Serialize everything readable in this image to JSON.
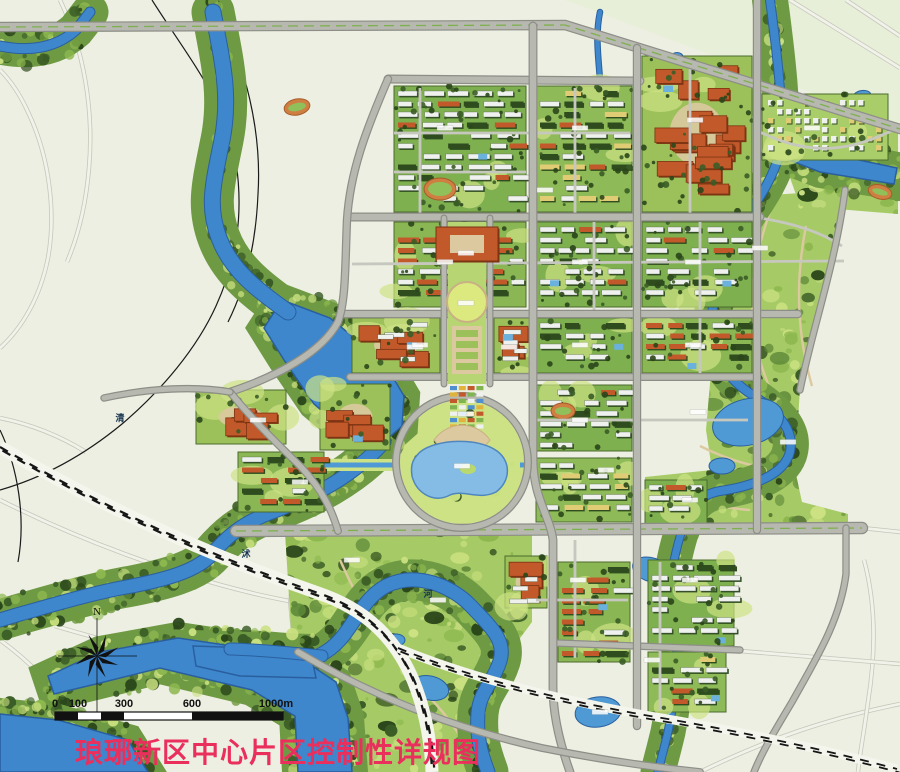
{
  "title": {
    "text": "琅琊新区中心片区控制性详规图"
  },
  "compass": {
    "label": "N"
  },
  "scale_bar": {
    "labels": [
      "0",
      "100",
      "300",
      "600",
      "1000m"
    ],
    "ticks_px": [
      55,
      78,
      124,
      192,
      283
    ]
  },
  "river_labels": [
    {
      "t": "清",
      "x": 120,
      "y": 421
    },
    {
      "t": "沭",
      "x": 246,
      "y": 557
    },
    {
      "t": "河",
      "x": 428,
      "y": 597
    }
  ],
  "palette": {
    "bg": "#edefe2",
    "tintNE": "#e8efd9",
    "roadFill": "#b7b8b0",
    "roadEdge": "#8d8e87",
    "minor": "#c6c7be",
    "outsideA": "#c6c7ba",
    "outsideB": "#f1f2e9",
    "river": "#3e87cc",
    "riverEdge": "#2a5f9f",
    "lake": "#85bce6",
    "pond": "#4f9ad4",
    "bank": "#6f9a44",
    "parkBase": "#a6cb66",
    "parkLight": "#cde284",
    "parkYellow": "#dce97f",
    "forest": "#3a5c26",
    "forestDark": "#2a461a",
    "grass": "#8db84f",
    "base_resw": "#7fb04f",
    "base_resr": "#8ab653",
    "base_resm": "#8fba58",
    "base_villa": "#a9cd68",
    "base_civic": "#9cc05a",
    "white": "#eff1ee",
    "red": "#c2592a",
    "redDark": "#7c3413",
    "yellow": "#e0cc74",
    "shadow": "#2f4d1f",
    "tan": "#dcc9a0",
    "tanEdge": "#c8b184",
    "rail": "#161616",
    "title": "#ea2f5d",
    "ink": "#111111",
    "water_label": "#14324f",
    "market": [
      "#4f8fd0",
      "#e2b33c",
      "#c2592a",
      "#7fb450",
      "#eff1ee"
    ],
    "track_ring": "#cf7f42",
    "track_field": "#8fc05a"
  },
  "geometry": {
    "tint_ne": "M565,0 L900,0 L900,126 Z",
    "outside_roads": [
      "M0,500 C80,540 170,574 260,595 C310,606 340,610 368,614",
      "M290,597 C293,650 305,705 318,772",
      "M55,626 C120,645 200,666 268,680 C320,692 372,708 424,722",
      "M0,640 C28,660 58,690 78,720 C93,745 99,760 101,772",
      "M700,772 C770,738 830,718 900,704",
      "M862,528 L900,532",
      "M864,560 C876,604 876,652 868,702 C864,732 860,752 858,772",
      "M740,651 L900,664",
      "M790,0 L900,68",
      "M846,0 L900,36",
      "M0,348 C22,328 40,298 48,258 C56,214 50,158 28,112 C18,90 8,78 0,70",
      "M60,0 C84,50 94,110 89,168 C86,204 79,234 67,262",
      "M0,418 C30,424 60,436 86,452"
    ],
    "black_lines": [
      "M152,0 C190,60 226,102 236,162 C244,216 236,262 216,306 C197,348 162,390 122,424 C82,457 42,478 0,490",
      "M216,0 C246,70 262,130 258,194 C256,242 246,286 228,322",
      "M0,430 C18,468 26,518 18,562"
    ],
    "parks": [
      {
        "name": "east-park-corridor",
        "d": "M757,196 L845,190 L800,388 L795,470 L802,502 L848,514 L848,527 L645,527 L645,477 L712,470 L706,430 L712,360 L726,300 L744,240 Z"
      },
      {
        "name": "villa-strip-park",
        "d": "M706,72 L898,130 L898,168 L784,146 Z"
      },
      {
        "name": "se-green-wedge",
        "d": "M788,172 L898,192 L898,214 L800,206 Z"
      },
      {
        "name": "bottom-park",
        "d": "M285,532 L532,532 L532,622 L504,660 L498,720 L492,772 L348,772 L318,700 L291,630 Z"
      }
    ],
    "park_paths": [
      "M770,212 C752,262 746,312 760,360 C768,392 786,416 796,446",
      "M806,226 C794,286 798,338 812,386",
      "M700,446 C732,462 762,470 792,470",
      "M660,490 C690,500 720,508 750,510",
      "M340,560 C362,610 392,658 428,696 C450,718 468,744 474,770",
      "M800,140 C820,148 846,150 868,142"
    ],
    "rivers_stroke": [
      {
        "d": "M213,12 C222,60 231,95 222,140 C213,185 207,206 219,238 C231,270 257,290 288,312",
        "w": 15
      },
      {
        "d": "M384,442 C352,478 310,498 272,512 C240,524 226,538 212,554 C196,572 162,580 132,586 C96,592 56,604 20,614 L0,620",
        "w": 13
      },
      {
        "d": "M0,46 C30,52 56,48 76,30 L90,12",
        "w": 9
      },
      {
        "d": "M770,0 C774,30 778,60 780,90 C782,115 783,135 780,152",
        "w": 8
      },
      {
        "d": "M780,152 C772,182 756,202 742,224 C724,252 716,282 712,314 C708,346 720,372 748,392 C778,411 797,431 789,455 C781,477 748,487 720,491 C698,495 688,509 682,530",
        "w": 8
      },
      {
        "d": "M682,530 C674,556 668,582 673,612 C680,646 676,692 668,732 C663,753 660,763 658,772",
        "w": 7
      },
      {
        "d": "M600,12 C592,50 606,85 598,120 C590,155 601,186 594,216",
        "w": 4.5
      },
      {
        "d": "M320,655 C352,640 356,602 386,586 C416,571 452,586 471,606 C492,628 506,641 500,661 C493,683 480,691 478,713 C476,741 483,758 488,772",
        "w": 13
      },
      {
        "d": "M230,649 C268,650 300,654 322,656",
        "w": 11
      }
    ],
    "rivers_poly": [
      "M282,300 L330,318 L384,362 L404,396 L402,426 L384,442 L352,436 L314,404 L284,360 L264,328 Z",
      "M48,676 L100,652 L178,638 L232,646 L300,658 L336,682 L348,718 L352,772 L298,772 L295,716 L252,690 L160,668 L96,684 L54,694 Z",
      "M0,714 L58,720 L128,740 L148,772 L0,772 Z",
      "M193,646 L310,650 L316,678 L240,676 L196,666 Z",
      "M782,144 L897,168 L894,184 L820,172 L784,158 Z"
    ],
    "canals": [
      "M262,465 L396,465",
      "M520,465 L630,465"
    ],
    "ponds": [
      {
        "cx": 748,
        "cy": 422,
        "rx": 36,
        "ry": 23,
        "rot": -14
      },
      {
        "cx": 722,
        "cy": 466,
        "rx": 13,
        "ry": 8,
        "rot": 0
      },
      {
        "cx": 652,
        "cy": 570,
        "rx": 20,
        "ry": 12,
        "rot": 18
      },
      {
        "cx": 598,
        "cy": 712,
        "rx": 23,
        "ry": 15,
        "rot": -8
      },
      {
        "cx": 430,
        "cy": 688,
        "rx": 19,
        "ry": 12,
        "rot": 14
      },
      {
        "cx": 396,
        "cy": 640,
        "rx": 9,
        "ry": 6,
        "rot": 0
      },
      {
        "cx": 862,
        "cy": 96,
        "rx": 9,
        "ry": 5.5,
        "rot": -10
      },
      {
        "cx": 816,
        "cy": 148,
        "rx": 9,
        "ry": 5,
        "rot": -10
      },
      {
        "cx": 677,
        "cy": 57,
        "rx": 6,
        "ry": 4.5,
        "rot": 0
      },
      {
        "cx": 723,
        "cy": 130,
        "rx": 7,
        "ry": 5,
        "rot": 0
      },
      {
        "cx": 505,
        "cy": 347,
        "rx": 8,
        "ry": 5,
        "rot": 0
      },
      {
        "cx": 447,
        "cy": 240,
        "rx": 7,
        "ry": 5,
        "rot": 0
      }
    ],
    "blocks": [
      {
        "x": 394,
        "y": 86,
        "w": 132,
        "h": 126,
        "k": "resw",
        "s": 11
      },
      {
        "x": 536,
        "y": 86,
        "w": 96,
        "h": 126,
        "k": "resm",
        "s": 12
      },
      {
        "x": 642,
        "y": 56,
        "w": 110,
        "h": 156,
        "k": "civic",
        "s": 13
      },
      {
        "x": 762,
        "y": 94,
        "w": 126,
        "h": 66,
        "k": "villa",
        "s": 14
      },
      {
        "x": 394,
        "y": 222,
        "w": 132,
        "h": 85,
        "k": "resr",
        "s": 15
      },
      {
        "x": 536,
        "y": 222,
        "w": 96,
        "h": 85,
        "k": "resw",
        "s": 16
      },
      {
        "x": 642,
        "y": 222,
        "w": 110,
        "h": 85,
        "k": "resw",
        "s": 17
      },
      {
        "x": 352,
        "y": 318,
        "w": 88,
        "h": 55,
        "k": "civic2",
        "s": 18
      },
      {
        "x": 494,
        "y": 318,
        "w": 38,
        "h": 55,
        "k": "civic2",
        "s": 19
      },
      {
        "x": 536,
        "y": 318,
        "w": 96,
        "h": 55,
        "k": "resw",
        "s": 20
      },
      {
        "x": 642,
        "y": 318,
        "w": 110,
        "h": 55,
        "k": "resr",
        "s": 21
      },
      {
        "x": 320,
        "y": 384,
        "w": 70,
        "h": 66,
        "k": "civic",
        "s": 22
      },
      {
        "x": 536,
        "y": 385,
        "w": 96,
        "h": 66,
        "k": "resw",
        "s": 23
      },
      {
        "x": 536,
        "y": 458,
        "w": 96,
        "h": 64,
        "k": "resm",
        "s": 24
      },
      {
        "x": 645,
        "y": 480,
        "w": 62,
        "h": 44,
        "k": "resw",
        "s": 25
      },
      {
        "x": 196,
        "y": 390,
        "w": 90,
        "h": 54,
        "k": "civic",
        "s": 26
      },
      {
        "x": 238,
        "y": 452,
        "w": 86,
        "h": 60,
        "k": "resr",
        "s": 27
      },
      {
        "x": 505,
        "y": 556,
        "w": 42,
        "h": 52,
        "k": "civic2",
        "s": 28
      },
      {
        "x": 558,
        "y": 562,
        "w": 72,
        "h": 100,
        "k": "resr",
        "s": 29
      },
      {
        "x": 648,
        "y": 560,
        "w": 86,
        "h": 86,
        "k": "resw",
        "s": 30
      },
      {
        "x": 648,
        "y": 652,
        "w": 78,
        "h": 60,
        "k": "resm",
        "s": 31
      }
    ],
    "roads_major": [
      {
        "d": "M0,27 L565,25 L900,129",
        "w": 8,
        "hw": true
      },
      {
        "d": "M388,79 L640,81",
        "w": 6.5
      },
      {
        "d": "M348,217 L760,217",
        "w": 6.5
      },
      {
        "d": "M342,314 L798,314",
        "w": 6
      },
      {
        "d": "M350,377 L756,377",
        "w": 5.5
      },
      {
        "d": "M236,531 L862,528",
        "w": 10,
        "med": true
      },
      {
        "d": "M556,643 L740,650",
        "w": 5
      },
      {
        "d": "M388,79 C366,130 350,172 347,220 C345,266 346,300 338,322 C322,352 278,376 230,392",
        "w": 6
      },
      {
        "d": "M230,392 C256,424 282,448 302,468 C322,490 332,510 338,531",
        "w": 5.5
      },
      {
        "d": "M230,392 C196,386 150,388 104,398",
        "w": 5
      },
      {
        "d": "M533,26 L533,458 C533,498 550,516 553,540 L553,688 C553,716 560,744 570,772",
        "w": 6.5
      },
      {
        "d": "M637,48 L637,726",
        "w": 6
      },
      {
        "d": "M757,0 L757,530",
        "w": 6
      },
      {
        "d": "M845,190 C836,262 812,330 800,390",
        "w": 5
      },
      {
        "d": "M846,528 L846,574 C840,622 814,662 792,702 C774,732 762,752 754,772",
        "w": 5
      },
      {
        "d": "M298,652 C372,696 452,728 542,748 C612,762 660,768 700,772",
        "w": 5.5
      },
      {
        "d": "M444,218 L444,384",
        "w": 4.5
      },
      {
        "d": "M490,218 L490,384",
        "w": 4.5
      }
    ],
    "roads_minor": [
      "M394,133 L630,133",
      "M394,172 L526,172",
      "M575,88 L575,215",
      "M690,62 L690,215",
      "M352,264 L844,261",
      "M594,222 L594,312",
      "M700,222 L700,375",
      "M536,420 L748,420",
      "M420,88 L420,215",
      "M575,540 L575,658",
      "M536,600 L628,600",
      "M660,562 L660,710",
      "M760,218 C798,224 824,234 842,246",
      "M760,132 C788,146 818,152 848,146 C868,142 884,134 894,130"
    ],
    "railway_main": "M0,447 C118,516 228,562 318,593 C368,610 396,640 413,680 C426,712 431,744 432,772",
    "railway_branch": "M398,648 C470,678 560,700 650,716 C740,731 830,751 897,769",
    "ring": {
      "cx": 462,
      "cy": 462,
      "r": 66
    },
    "axis": {
      "base": {
        "x": 448,
        "y": 222,
        "w": 38,
        "h": 162
      },
      "head": {
        "x": 436,
        "y": 227,
        "w": 62,
        "h": 34
      },
      "semicircle": {
        "cx": 467,
        "cy": 302,
        "r": 20
      },
      "garden": {
        "x": 452,
        "y": 326,
        "w": 30,
        "h": 48
      },
      "market": {
        "x": 449,
        "y": 384,
        "w": 36,
        "h": 46
      },
      "fan": "M434,440 A34,34 0 0 1 490,440 L477,456 A16,16 0 0 0 447,456 Z",
      "lake": "M420,452 C436,439 478,437 497,451 C512,462 510,482 496,492 C478,501 462,488 448,496 C432,503 416,492 412,476 C410,463 414,458 420,452 Z",
      "island": {
        "cx": 468,
        "cy": 469,
        "rx": 8,
        "ry": 5
      }
    },
    "ovals": [
      {
        "cx": 297,
        "cy": 107,
        "rx": 13,
        "ry": 8,
        "rot": -12
      },
      {
        "cx": 440,
        "cy": 189,
        "rx": 16,
        "ry": 11,
        "rot": 0
      },
      {
        "cx": 563,
        "cy": 411,
        "rx": 12,
        "ry": 8,
        "rot": 0
      },
      {
        "cx": 880,
        "cy": 192,
        "rx": 12,
        "ry": 7,
        "rot": 15
      }
    ],
    "chips": [
      [
        466,
        253
      ],
      [
        466,
        303
      ],
      [
        415,
        347
      ],
      [
        509,
        347
      ],
      [
        466,
        414
      ],
      [
        462,
        466
      ],
      [
        258,
        420
      ],
      [
        300,
        482
      ],
      [
        445,
        128
      ],
      [
        580,
        128
      ],
      [
        695,
        120
      ],
      [
        812,
        128
      ],
      [
        445,
        262
      ],
      [
        580,
        262
      ],
      [
        693,
        262
      ],
      [
        420,
        345
      ],
      [
        580,
        345
      ],
      [
        693,
        345
      ],
      [
        580,
        420
      ],
      [
        690,
        500
      ],
      [
        578,
        580
      ],
      [
        690,
        580
      ],
      [
        760,
        248
      ],
      [
        788,
        442
      ],
      [
        652,
        660
      ],
      [
        600,
        712
      ],
      [
        352,
        560
      ],
      [
        438,
        600
      ],
      [
        545,
        190
      ],
      [
        606,
        470
      ],
      [
        698,
        412
      ]
    ],
    "compass": {
      "cx": 97,
      "cy": 656,
      "r": 23
    },
    "scale_bar": {
      "x": 55,
      "y": 712,
      "h": 8,
      "end": 283,
      "black_segs": [
        [
          55,
          78
        ],
        [
          101,
          124
        ],
        [
          192,
          283
        ]
      ]
    }
  }
}
